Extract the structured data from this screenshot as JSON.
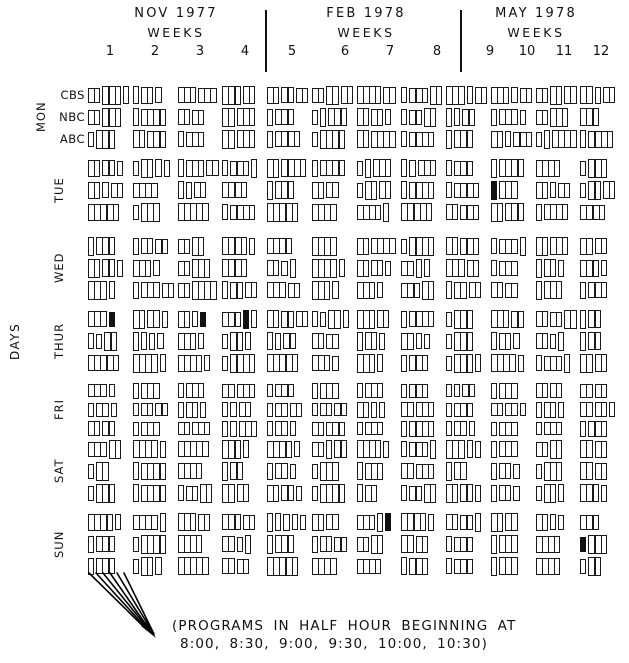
{
  "figure": {
    "months": [
      {
        "label": "NOV 1977",
        "weeks_label": "WEEKS"
      },
      {
        "label": "FEB 1978",
        "weeks_label": "WEEKS"
      },
      {
        "label": "MAY 1978",
        "weeks_label": "WEEKS"
      }
    ],
    "week_numbers": [
      "1",
      "2",
      "3",
      "4",
      "5",
      "6",
      "7",
      "8",
      "9",
      "10",
      "11",
      "12"
    ],
    "days_axis_label": "DAYS",
    "days": [
      "MON",
      "TUE",
      "WED",
      "THUR",
      "FRI",
      "SAT",
      "SUN"
    ],
    "networks": [
      "CBS",
      "NBC",
      "ABC"
    ],
    "annotation": {
      "line1": "(PROGRAMS IN HALF HOUR BEGINNING AT",
      "line2": "8:00, 8:30, 9:00, 9:30, 10:00, 10:30)"
    },
    "colors": {
      "ink": "#111111",
      "background": "#ffffff"
    }
  },
  "chart_data": {
    "type": "heatmap",
    "subtype": "prime-time-schedule-grid",
    "title": "",
    "x": {
      "label": "WEEKS",
      "groups": [
        "NOV 1977",
        "FEB 1978",
        "MAY 1978"
      ],
      "ticks": [
        "1",
        "2",
        "3",
        "4",
        "5",
        "6",
        "7",
        "8",
        "9",
        "10",
        "11",
        "12"
      ]
    },
    "y": {
      "label": "DAYS",
      "ticks": [
        "MON",
        "TUE",
        "WED",
        "THUR",
        "FRI",
        "SAT",
        "SUN"
      ],
      "subrows": [
        "CBS",
        "NBC",
        "ABC"
      ]
    },
    "slot_times": [
      "8:00",
      "8:30",
      "9:00",
      "9:30",
      "10:00",
      "10:30"
    ],
    "encoding": "Each cell = one network's evening for that week; string digits are consecutive program lengths in half-hour slots (e.g. \"132\" = 0.5h, 1.5h, 1h programs); F = filled (solid) half-hour bar",
    "grid": {
      "MON": {
        "CBS": [
          "231",
          "121",
          "33",
          "32",
          "222",
          "222",
          "42",
          "132",
          "312",
          "312",
          "222",
          "212"
        ],
        "NBC": [
          "23",
          "14",
          "22",
          "23",
          "13",
          "113",
          "221",
          "122",
          "112",
          "131",
          "23",
          "3"
        ],
        "ABC": [
          "13",
          "23",
          "13",
          "23",
          "14",
          "14",
          "24",
          "14",
          "13",
          "213",
          "114",
          "14"
        ]
      },
      "TUE": {
        "CBS": [
          "221",
          "1211",
          "132",
          "131",
          "24",
          "14",
          "113",
          "113",
          "13",
          "14",
          "4",
          "13"
        ],
        "NBC": [
          "212",
          "4",
          "112",
          "4",
          "13",
          "22",
          "122",
          "14",
          "14",
          "F3",
          "212",
          "122"
        ],
        "ABC": [
          "5",
          "13",
          "5",
          "14",
          "5",
          "4",
          "41",
          "5",
          "23",
          "23",
          "14",
          "4"
        ]
      },
      "WED": {
        "CBS": [
          "13",
          "122",
          "22",
          "41",
          "4",
          "4",
          "24",
          "14",
          "23",
          "131",
          "23",
          "22"
        ],
        "NBC": [
          "221",
          "31",
          "23",
          "4",
          "211",
          "41",
          "221",
          "211",
          "32",
          "13",
          "121",
          "31"
        ],
        "ABC": [
          "31",
          "132",
          "24",
          "122",
          "32",
          "31",
          "31",
          "32",
          "122",
          "22",
          "13",
          "13"
        ]
      },
      "THUR": {
        "CBS": [
          "3F",
          "221",
          "21F",
          "3F1",
          "222",
          "1121",
          "32",
          "14",
          "13",
          "32",
          "222",
          "12"
        ],
        "NBC": [
          "112",
          "1111",
          "31",
          "121",
          "112",
          "22",
          "121",
          "211",
          "13",
          "121",
          "211",
          "12"
        ],
        "ABC": [
          "5",
          "41",
          "41",
          "14",
          "5",
          "31",
          "31",
          "13",
          "131",
          "41",
          "131",
          "22"
        ]
      },
      "FRI": {
        "CBS": [
          "31",
          "13",
          "13",
          "23",
          "13",
          "13",
          "13",
          "13",
          "112",
          "13",
          "22",
          "22"
        ],
        "NBC": [
          "121",
          "122",
          "121",
          "112",
          "122",
          "122",
          "211",
          "23",
          "13",
          "221",
          "121",
          "221"
        ],
        "ABC": [
          "22",
          "13",
          "23",
          "113",
          "121",
          "23",
          "13",
          "14",
          "121",
          "13",
          "13",
          "13"
        ]
      },
      "SAT": {
        "CBS": [
          "32",
          "41",
          "5",
          "31",
          "41",
          "212",
          "41",
          "131",
          "311",
          "13",
          "22",
          "22"
        ],
        "NBC": [
          "12",
          "14",
          "4",
          "12",
          "121",
          "13",
          "13",
          "23",
          "12",
          "121",
          "13",
          "22"
        ],
        "ABC": [
          "13",
          "14",
          "122",
          "22",
          "221",
          "14",
          "12",
          "122",
          "221",
          "121",
          "121",
          "31"
        ]
      },
      "SUN": {
        "CBS": [
          "41",
          "41",
          "32",
          "32",
          "11111",
          "22",
          "31F",
          "41",
          "221",
          "22",
          "211",
          "3"
        ],
        "NBC": [
          "13",
          "14",
          "4",
          "211",
          "13",
          "122",
          "22",
          "22",
          "13",
          "13",
          "4",
          "F3"
        ],
        "ABC": [
          "13",
          "121",
          "5",
          "22",
          "5",
          "4",
          "4",
          "13",
          "13",
          "13",
          "4",
          "12"
        ]
      }
    }
  }
}
